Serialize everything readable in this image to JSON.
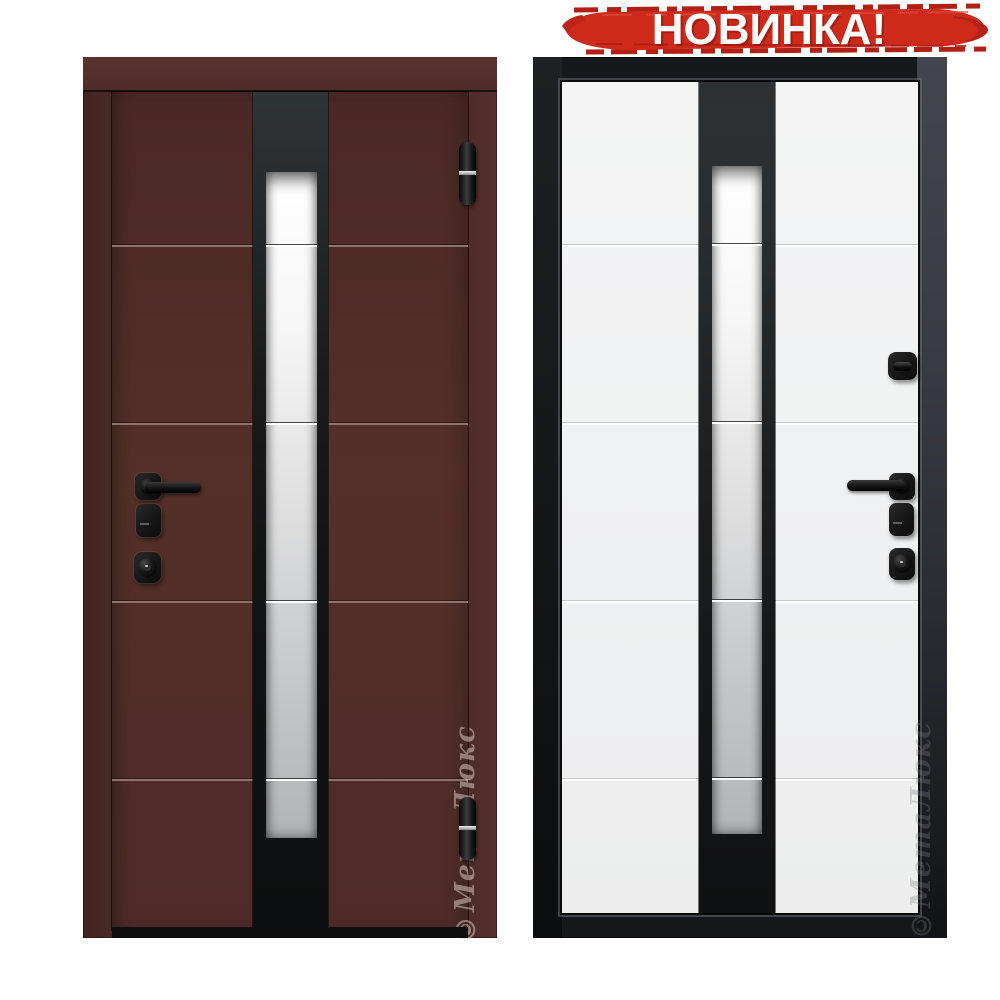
{
  "badge": {
    "label": "НОВИНКА!"
  },
  "watermark": {
    "text": "©МетаЛюкс"
  },
  "colors": {
    "badge_red": "#ce2a1c",
    "badge_red_dark": "#a81d10",
    "badge_text": "#ffffff",
    "maroon_frame": "#4c2926",
    "maroon_leaf": "#502c29",
    "maroon_groove_light": "#9c7f76",
    "white_panel": "#f1f1f2",
    "dark_frame": "#17181b",
    "strip_black": "#141517",
    "glass_top": "#ffffff",
    "glass_bottom": "#b2b4b6",
    "hardware_black": "#161616",
    "logo_on_maroon": "rgba(231,211,204,0.5)",
    "logo_on_white": "rgba(125,128,133,0.32)"
  }
}
